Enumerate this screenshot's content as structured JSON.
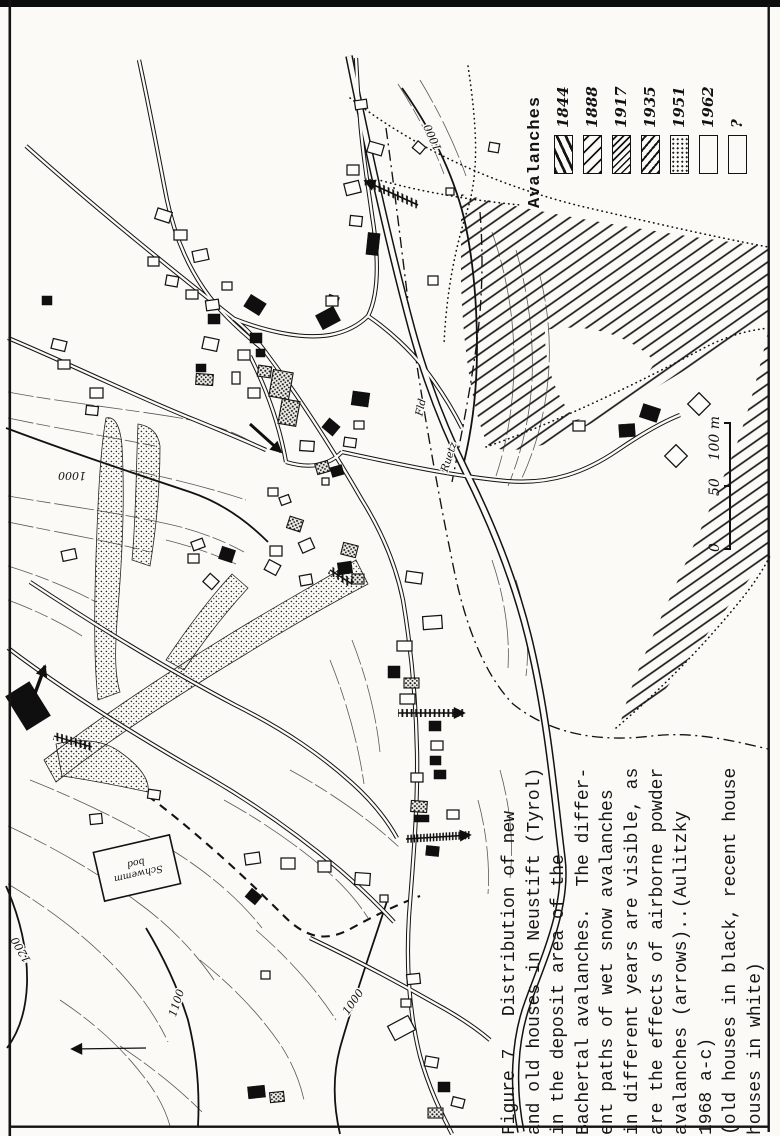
{
  "figure": {
    "legend": {
      "title": "Avalanches",
      "items": [
        {
          "year": "1844",
          "pattern": "bold-steep-hatch"
        },
        {
          "year": "1888",
          "pattern": "diagonal-hatch"
        },
        {
          "year": "1917",
          "pattern": "dense-diagonal-hatch"
        },
        {
          "year": "1935",
          "pattern": "diagonal-hatch"
        },
        {
          "year": "1951",
          "pattern": "stipple-dots"
        },
        {
          "year": "1962",
          "pattern": "empty"
        },
        {
          "year": "?",
          "pattern": "empty"
        }
      ]
    },
    "scale_bar": {
      "labels": [
        "0",
        "50",
        "100 m"
      ]
    },
    "caption": {
      "lines": [
        "Figure 7   Distribution of new",
        "and old houses in Neustift (Tyrol)",
        "in the deposit area of the",
        "Bachertal avalanches.  The differ-",
        "ent paths of wet snow avalanches",
        "in different years are visible, as",
        "are the effects of airborne powder",
        "avalanches (arrows)..(Aulitzky",
        "1968 a-c)",
        "(old houses in black, recent house",
        "houses in white)"
      ]
    }
  },
  "map": {
    "ink": "#141414",
    "paper": "#fbfaf7",
    "contour_labels": [
      {
        "text": "1000",
        "x": 72,
        "y": 472,
        "rot": 180
      },
      {
        "text": "1000",
        "x": 436,
        "y": 136,
        "rot": 246
      },
      {
        "text": "1000",
        "x": 356,
        "y": 1004,
        "rot": -55
      },
      {
        "text": "1100",
        "x": 180,
        "y": 1004,
        "rot": -72
      },
      {
        "text": "1200",
        "x": 24,
        "y": 948,
        "rot": 240
      }
    ],
    "river_labels": [
      {
        "text": "Ruetz",
        "x": 452,
        "y": 458,
        "rot": -72
      },
      {
        "text": "Fld",
        "x": 424,
        "y": 408,
        "rot": -78
      }
    ],
    "note_box": {
      "x": 98,
      "y": 843,
      "w": 78,
      "h": 50,
      "rot": -13,
      "lines": [
        "Schwemm",
        "bod"
      ]
    },
    "areas": [
      {
        "n": "avalanche-hatch-area",
        "p": "bigHatch",
        "d": "M 461,194 C 545,214 650,232 768,247 L 768,318 C 700,362 622,410 562,438 C 534,450 502,454 488,445 C 473,414 463,350 461,282 Z"
      },
      {
        "n": "hatch-area-gap",
        "p": "paper",
        "d": "M 545,330 C 585,322 630,334 655,362 C 638,392 607,412 576,420 C 556,398 544,364 545,330 Z"
      },
      {
        "n": "avalanche-hatch-area",
        "p": "bigHatch",
        "d": "M 768,332 L 768,556 C 735,596 700,644 668,686 C 651,707 634,721 620,726 C 625,700 642,660 663,613 C 687,560 713,503 735,449 C 747,417 759,372 768,332 Z"
      }
    ],
    "tongues": [
      {
        "d": "M 106,418 C 114,416 120,424 122,446 C 125,500 122,560 118,608 C 115,646 114,672 120,692 L 98,700 C 94,664 94,612 96,556 C 98,500 100,452 106,418 Z"
      },
      {
        "d": "M 44,760 C 110,710 180,664 250,622 C 290,598 330,576 356,560 L 368,584 C 330,604 288,628 246,654 C 180,694 114,736 56,782 Z"
      },
      {
        "d": "M 166,660 C 186,630 208,600 232,574 L 248,588 C 226,612 204,640 184,670 Z"
      },
      {
        "d": "M 138,424 C 150,426 158,432 160,446 C 160,490 156,530 150,566 L 132,560 C 136,520 136,470 138,424 Z"
      },
      {
        "d": "M 56,744 C 80,738 104,740 120,752 C 140,766 150,780 148,792 C 120,786 90,780 62,776 Z"
      }
    ],
    "dotted_edges": [
      {
        "d": "M 350,98 C 420,152 500,186 580,206 C 645,221 710,236 768,247"
      },
      {
        "d": "M 486,447 C 560,421 640,382 700,350 C 726,336 748,330 770,328"
      },
      {
        "d": "M 616,728 C 658,692 700,650 740,601 C 753,585 763,570 770,556"
      },
      {
        "d": "M 372,178 C 420,192 470,200 520,205"
      },
      {
        "d": "M 468,66 C 476,120 480,168 468,208 C 452,258 446,302 444,344"
      }
    ],
    "boundaries": [
      {
        "d": "M 386,128 C 396,200 403,262 412,332 C 422,402 436,482 452,560 C 464,622 483,673 513,704 C 553,736 603,742 652,736 C 694,731 734,741 768,749"
      },
      {
        "d": "M 480,212 C 484,262 482,312 474,362 C 468,402 460,442 452,482"
      }
    ],
    "dashed_paths": [
      {
        "d": "M 148,796 C 186,824 236,868 284,916 C 304,936 324,944 352,928 C 374,916 394,906 420,896"
      }
    ],
    "contours_index": [
      {
        "d": "M 6,428 C 70,452 130,472 190,492 C 220,502 246,520 268,542"
      },
      {
        "d": "M 402,88 C 430,128 452,170 464,218 C 473,258 477,304 477,348 C 477,390 472,432 462,470"
      },
      {
        "d": "M 388,898 C 372,948 354,998 340,1048 C 332,1078 334,1108 340,1134"
      },
      {
        "d": "M 146,928 C 164,958 178,988 188,1020 C 196,1052 200,1088 198,1126"
      },
      {
        "d": "M 6,886 C 20,918 28,950 27,984 C 26,1010 19,1032 7,1048"
      }
    ],
    "contours_minor": [
      {
        "d": "M 8,392 C 60,402 120,408 180,418 C 215,424 240,434 258,446"
      },
      {
        "d": "M 8,418 C 55,428 105,436 155,446"
      },
      {
        "d": "M 8,496 C 60,505 115,512 168,524 C 196,530 222,540 244,552"
      },
      {
        "d": "M 8,522 C 55,532 105,540 150,552"
      },
      {
        "d": "M 8,566 C 40,576 70,588 96,602"
      },
      {
        "d": "M 8,600 C 35,610 60,622 82,636"
      },
      {
        "d": "M 130,470 C 170,478 210,488 246,500"
      },
      {
        "d": "M 166,540 C 190,546 214,554 236,564"
      },
      {
        "d": "M 30,780 C 80,800 130,824 175,852 C 210,874 240,900 262,928"
      },
      {
        "d": "M 8,826 C 55,848 100,874 140,904 C 170,926 195,952 214,980"
      },
      {
        "d": "M 8,884 C 45,906 80,932 110,962 C 135,987 155,1014 168,1042"
      },
      {
        "d": "M 60,1000 C 90,1020 118,1044 140,1072 C 155,1090 165,1108 170,1126"
      },
      {
        "d": "M 120,1046 C 150,1066 178,1088 202,1112"
      },
      {
        "d": "M 200,960 C 230,984 258,1012 280,1044 C 292,1062 300,1082 304,1100"
      },
      {
        "d": "M 256,930 C 286,956 314,986 336,1020"
      },
      {
        "d": "M 224,800 C 260,820 296,844 328,872 C 344,886 358,902 368,918"
      },
      {
        "d": "M 290,770 C 330,792 368,818 400,848"
      },
      {
        "d": "M 492,232 C 506,272 514,316 514,360 C 514,400 508,440 496,476"
      },
      {
        "d": "M 516,250 C 528,292 534,336 532,380 C 530,416 522,452 508,486"
      },
      {
        "d": "M 540,276 C 550,316 552,356 546,396 C 542,424 534,452 522,478"
      },
      {
        "d": "M 492,560 C 504,596 510,632 508,668"
      },
      {
        "d": "M 516,580 C 526,612 530,644 526,676"
      },
      {
        "d": "M 398,84 C 416,112 432,142 444,174"
      },
      {
        "d": "M 420,80 C 438,110 454,142 466,176"
      },
      {
        "d": "M 352,640 C 366,676 376,714 380,752"
      },
      {
        "d": "M 330,660 C 346,700 358,742 364,784"
      },
      {
        "d": "M 500,770 C 510,806 514,842 510,878"
      },
      {
        "d": "M 478,800 C 486,830 490,862 488,894"
      }
    ],
    "river": {
      "d": "M 349,56 C 362,120 385,230 412,330 C 428,388 446,432 466,472 C 492,524 516,582 531,648 C 548,722 554,792 562,858 C 568,906 545,955 528,1002 C 514,1040 512,1088 521,1132"
    },
    "roads": [
      {
        "d": "M 139,60 C 152,120 160,165 167,200 C 178,252 200,290 228,318 C 242,332 254,342 264,350"
      },
      {
        "d": "M 26,146 C 100,212 170,268 228,314 C 241,324 252,334 264,350"
      },
      {
        "d": "M 264,350 C 300,398 332,448 362,500 C 382,532 396,566 403,600 C 411,648 416,700 417,752 C 418,808 413,862 409,916 C 406,965 409,1012 420,1056 C 430,1092 444,1118 452,1134"
      },
      {
        "d": "M 8,338 C 70,364 135,396 195,420 C 222,431 246,441 266,450"
      },
      {
        "d": "M 342,452 C 398,464 452,476 506,481 C 551,485 586,472 618,450 C 640,435 660,423 680,415"
      },
      {
        "d": "M 30,582 C 95,625 165,668 235,705 C 287,731 322,756 352,783 C 372,801 387,820 397,838"
      },
      {
        "d": "M 8,648 C 70,695 140,738 210,778 C 258,806 302,838 340,870 C 362,889 380,907 394,922"
      },
      {
        "d": "M 250,356 C 268,392 280,428 286,462"
      },
      {
        "d": "M 286,462 C 306,468 326,468 342,452"
      },
      {
        "d": "M 356,58 C 357,78 358,96 360,118 C 362,150 368,185 372,215 C 378,252 380,292 368,316 C 358,326 346,332 330,335 C 300,340 262,330 232,318"
      },
      {
        "d": "M 368,316 C 390,331 410,350 424,368 C 438,386 452,408 462,428"
      },
      {
        "d": "M 310,938 C 352,958 394,980 436,1004 C 458,1016 476,1028 490,1040"
      }
    ],
    "houses": [
      [
        156,
        210,
        15,
        11,
        18,
        "w"
      ],
      [
        174,
        230,
        13,
        10,
        0,
        "w"
      ],
      [
        193,
        250,
        15,
        11,
        -12,
        "w"
      ],
      [
        148,
        257,
        11,
        9,
        0,
        "w"
      ],
      [
        166,
        276,
        12,
        10,
        10,
        "w"
      ],
      [
        186,
        290,
        12,
        9,
        0,
        "w"
      ],
      [
        206,
        300,
        13,
        10,
        -8,
        "w"
      ],
      [
        42,
        296,
        10,
        9,
        0,
        "b"
      ],
      [
        52,
        340,
        14,
        10,
        14,
        "w"
      ],
      [
        58,
        360,
        12,
        9,
        0,
        "w"
      ],
      [
        90,
        388,
        13,
        10,
        0,
        "w"
      ],
      [
        86,
        406,
        12,
        9,
        6,
        "w"
      ],
      [
        222,
        282,
        10,
        8,
        0,
        "w"
      ],
      [
        246,
        298,
        18,
        14,
        32,
        "b"
      ],
      [
        208,
        314,
        12,
        10,
        0,
        "b"
      ],
      [
        203,
        338,
        15,
        12,
        12,
        "w"
      ],
      [
        318,
        310,
        20,
        16,
        -28,
        "b"
      ],
      [
        328,
        296,
        10,
        8,
        20,
        "w"
      ],
      [
        250,
        333,
        12,
        10,
        0,
        "b"
      ],
      [
        238,
        350,
        12,
        10,
        0,
        "w"
      ],
      [
        256,
        349,
        9,
        8,
        0,
        "b"
      ],
      [
        196,
        364,
        10,
        8,
        0,
        "b"
      ],
      [
        196,
        374,
        17,
        11,
        4,
        "s"
      ],
      [
        232,
        372,
        8,
        12,
        0,
        "w"
      ],
      [
        258,
        366,
        13,
        11,
        8,
        "s"
      ],
      [
        248,
        388,
        12,
        10,
        0,
        "w"
      ],
      [
        271,
        371,
        20,
        27,
        10,
        "s"
      ],
      [
        280,
        400,
        18,
        25,
        10,
        "s"
      ],
      [
        300,
        441,
        14,
        10,
        4,
        "w"
      ],
      [
        352,
        392,
        17,
        14,
        8,
        "b"
      ],
      [
        354,
        421,
        10,
        8,
        0,
        "w"
      ],
      [
        324,
        421,
        14,
        12,
        40,
        "b"
      ],
      [
        344,
        438,
        12,
        9,
        8,
        "w"
      ],
      [
        316,
        462,
        13,
        11,
        -16,
        "s"
      ],
      [
        331,
        466,
        12,
        10,
        -16,
        "b"
      ],
      [
        268,
        488,
        10,
        8,
        0,
        "w"
      ],
      [
        280,
        496,
        10,
        8,
        -20,
        "w"
      ],
      [
        322,
        478,
        7,
        7,
        0,
        "w"
      ],
      [
        288,
        518,
        14,
        12,
        18,
        "s"
      ],
      [
        300,
        540,
        13,
        11,
        -24,
        "w"
      ],
      [
        270,
        546,
        12,
        10,
        0,
        "w"
      ],
      [
        266,
        562,
        13,
        11,
        28,
        "w"
      ],
      [
        342,
        544,
        15,
        12,
        14,
        "s"
      ],
      [
        338,
        562,
        14,
        12,
        -8,
        "b"
      ],
      [
        352,
        574,
        12,
        10,
        0,
        "s"
      ],
      [
        300,
        575,
        12,
        10,
        -10,
        "w"
      ],
      [
        355,
        100,
        12,
        9,
        -8,
        "w"
      ],
      [
        368,
        143,
        15,
        11,
        16,
        "w"
      ],
      [
        347,
        165,
        12,
        10,
        0,
        "w"
      ],
      [
        345,
        182,
        15,
        12,
        -14,
        "w"
      ],
      [
        350,
        216,
        12,
        10,
        6,
        "w"
      ],
      [
        367,
        233,
        12,
        22,
        6,
        "b"
      ],
      [
        326,
        296,
        12,
        10,
        0,
        "w"
      ],
      [
        414,
        143,
        10,
        9,
        40,
        "w"
      ],
      [
        489,
        143,
        10,
        9,
        10,
        "w"
      ],
      [
        428,
        276,
        10,
        9,
        0,
        "w"
      ],
      [
        446,
        188,
        8,
        7,
        0,
        "w"
      ],
      [
        573,
        421,
        12,
        10,
        0,
        "w"
      ],
      [
        619,
        424,
        16,
        13,
        -4,
        "b"
      ],
      [
        641,
        406,
        18,
        14,
        18,
        "b"
      ],
      [
        668,
        448,
        16,
        16,
        45,
        "w"
      ],
      [
        691,
        396,
        16,
        16,
        45,
        "w"
      ],
      [
        406,
        572,
        16,
        11,
        8,
        "w"
      ],
      [
        423,
        616,
        19,
        13,
        -4,
        "w"
      ],
      [
        397,
        641,
        15,
        10,
        0,
        "w"
      ],
      [
        388,
        666,
        12,
        12,
        0,
        "b"
      ],
      [
        404,
        678,
        15,
        10,
        0,
        "s"
      ],
      [
        400,
        694,
        15,
        10,
        0,
        "w"
      ],
      [
        429,
        721,
        12,
        10,
        0,
        "b"
      ],
      [
        431,
        741,
        12,
        9,
        0,
        "w"
      ],
      [
        430,
        756,
        11,
        9,
        0,
        "b"
      ],
      [
        434,
        770,
        12,
        9,
        0,
        "b"
      ],
      [
        411,
        773,
        12,
        9,
        0,
        "w"
      ],
      [
        411,
        801,
        16,
        11,
        4,
        "s"
      ],
      [
        414,
        815,
        15,
        7,
        0,
        "b"
      ],
      [
        447,
        810,
        12,
        9,
        0,
        "w"
      ],
      [
        426,
        846,
        13,
        10,
        6,
        "b"
      ],
      [
        407,
        974,
        13,
        10,
        -6,
        "w"
      ],
      [
        401,
        999,
        10,
        8,
        0,
        "w"
      ],
      [
        390,
        1020,
        23,
        16,
        -28,
        "w"
      ],
      [
        425,
        1057,
        13,
        10,
        10,
        "w"
      ],
      [
        438,
        1082,
        12,
        10,
        0,
        "b"
      ],
      [
        452,
        1098,
        12,
        9,
        14,
        "w"
      ],
      [
        428,
        1108,
        15,
        10,
        0,
        "s"
      ],
      [
        245,
        853,
        15,
        11,
        -8,
        "w"
      ],
      [
        281,
        858,
        14,
        11,
        0,
        "w"
      ],
      [
        318,
        861,
        13,
        11,
        0,
        "w"
      ],
      [
        355,
        873,
        15,
        12,
        4,
        "w"
      ],
      [
        247,
        891,
        13,
        11,
        40,
        "b"
      ],
      [
        380,
        895,
        8,
        7,
        0,
        "w"
      ],
      [
        261,
        971,
        9,
        8,
        0,
        "w"
      ],
      [
        90,
        814,
        12,
        10,
        -6,
        "w"
      ],
      [
        62,
        550,
        14,
        10,
        -12,
        "w"
      ],
      [
        192,
        540,
        12,
        9,
        -20,
        "w"
      ],
      [
        188,
        554,
        11,
        9,
        0,
        "w"
      ],
      [
        205,
        576,
        12,
        11,
        42,
        "w"
      ],
      [
        220,
        548,
        14,
        13,
        18,
        "b"
      ],
      [
        14,
        686,
        28,
        40,
        -32,
        "b"
      ],
      [
        148,
        790,
        12,
        9,
        8,
        "w"
      ],
      [
        248,
        1086,
        17,
        12,
        -6,
        "b"
      ],
      [
        270,
        1092,
        14,
        10,
        -6,
        "s"
      ]
    ],
    "arrows": [
      {
        "x1": 418,
        "y1": 205,
        "x2": 365,
        "y2": 181,
        "style": "ladder",
        "head": true,
        "lw": 1.6
      },
      {
        "x1": 26,
        "y1": 718,
        "x2": 45,
        "y2": 666,
        "style": "bold",
        "head": true,
        "lw": 3.4
      },
      {
        "x1": 398,
        "y1": 713,
        "x2": 464,
        "y2": 713,
        "style": "ladder",
        "head": true,
        "lw": 1.6
      },
      {
        "x1": 406,
        "y1": 839,
        "x2": 470,
        "y2": 835,
        "style": "ladder-dense",
        "head": true,
        "lw": 1.6
      },
      {
        "x1": 146,
        "y1": 1048,
        "x2": 72,
        "y2": 1049,
        "style": "thin",
        "head": true,
        "lw": 1.2
      },
      {
        "x1": 250,
        "y1": 424,
        "x2": 281,
        "y2": 452,
        "style": "bold",
        "head": true,
        "lw": 3
      },
      {
        "x1": 54,
        "y1": 736,
        "x2": 92,
        "y2": 747,
        "style": "ladder",
        "head": false,
        "lw": 1.4
      },
      {
        "x1": 330,
        "y1": 570,
        "x2": 352,
        "y2": 584,
        "style": "ladder",
        "head": false,
        "lw": 1.4
      }
    ]
  }
}
